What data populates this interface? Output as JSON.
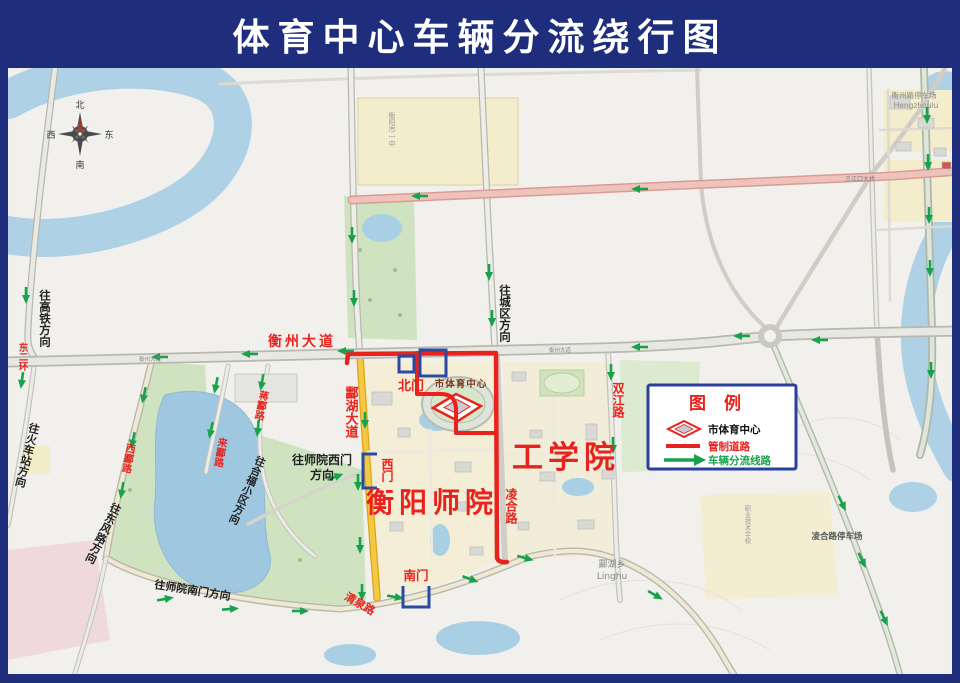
{
  "title": "体育中心车辆分流绕行图",
  "compass": {
    "n": "北",
    "s": "南",
    "e": "东",
    "w": "西"
  },
  "legend": {
    "title": "图  例",
    "items": [
      {
        "icon": "sports-center-diamond",
        "label": "市体育中心"
      },
      {
        "icon": "red-line",
        "label": "管制道路"
      },
      {
        "icon": "green-arrow",
        "label": "车辆分流线路"
      }
    ]
  },
  "roads": {
    "hengzhou_avenue": "衡州大道",
    "hengzhou_avenue_small": "衡州大道",
    "linghu_avenue": "酃湖大道",
    "linghe_road": "凌合路",
    "shuangjiang_road": "双江路",
    "qingquan_road": "清泉路",
    "xiling_road": "西酃路",
    "lailing_road": "来酃路",
    "jiangling_road": "蒋酃路",
    "east_second_ring": "东二环",
    "sanjiangkou_bridge": "三江口大桥"
  },
  "directions": {
    "to_gaotie": "往高铁方向",
    "to_city": "往城区方向",
    "to_train_station": "往火车站方向",
    "to_dongfeng": "往东风路方向",
    "to_hefu": "往合福小区方向",
    "to_shiyuan_west_line1": "往师院西门",
    "to_shiyuan_west_line2": "方向",
    "to_shiyuan_south": "往师院南门方向"
  },
  "places": {
    "normal_college": "衡阳师院",
    "engineering_college": "工学院",
    "sports_center": "市体育中心",
    "north_gate": "北门",
    "west_gate": "西门",
    "south_gate": "南门",
    "linghu_township": "酃湖乡",
    "linghu_pinyin": "Linghu",
    "linghe_parking": "凌合路停车场",
    "hengzhou_parking": "衡州路停车场",
    "hengzhou_pinyin": "Hengzhoulu",
    "school_block": "衡阳市一中",
    "vocational_school": "职业技术学校"
  },
  "colors": {
    "frame": "#1e2e7d",
    "restricted_road": "#e8221c",
    "diversion_green": "#18a24b",
    "gate_marker": "#2b4aa0",
    "yellow_road": "#f5c842"
  }
}
